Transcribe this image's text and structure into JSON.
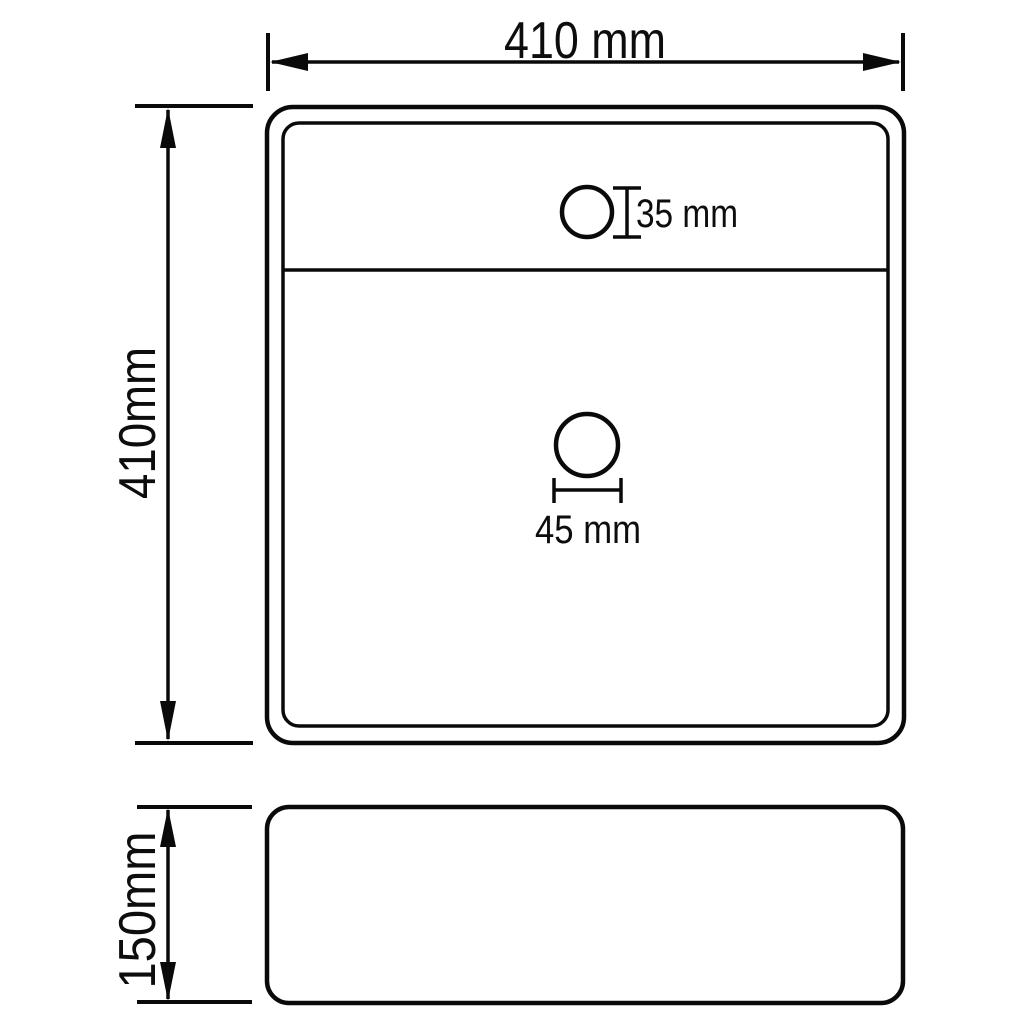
{
  "diagram": {
    "title": "Washbasin dimension drawing",
    "colors": {
      "line": "#0a0a0a",
      "background": "#ffffff"
    },
    "top_view": {
      "name": "top view",
      "width_dimension": {
        "label": "410 mm",
        "value_mm": 410
      },
      "depth_dimension": {
        "label": "410mm",
        "value_mm": 410
      },
      "faucet_hole": {
        "label": "35 mm",
        "diameter_mm": 35
      },
      "drain_hole": {
        "label": "45 mm",
        "diameter_mm": 45
      }
    },
    "side_view": {
      "name": "side view",
      "height_dimension": {
        "label": "150mm",
        "value_mm": 150
      }
    }
  }
}
